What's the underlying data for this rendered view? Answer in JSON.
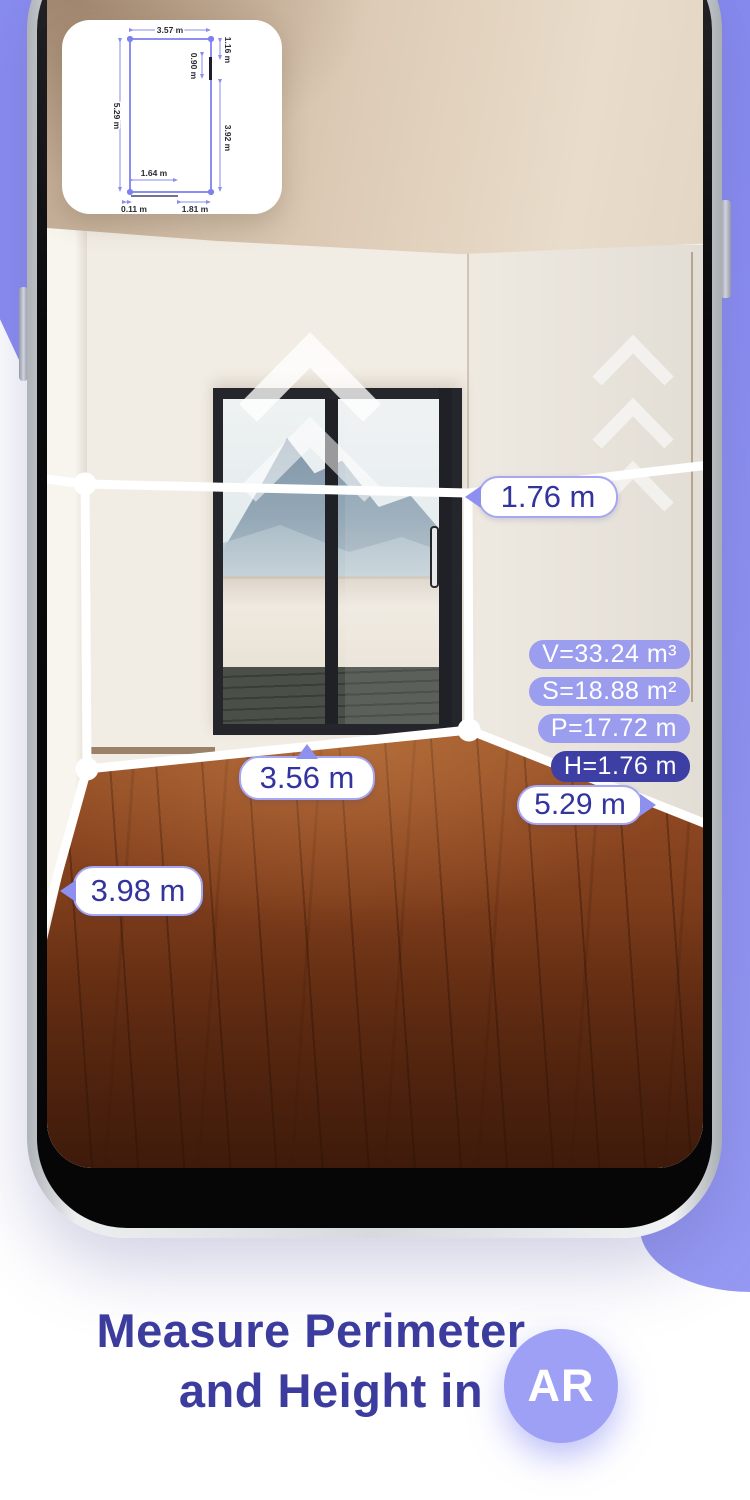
{
  "floor_plan": {
    "top": "3.57 m",
    "right_top": "1.16 m",
    "window": "0.90 m",
    "left": "5.29 m",
    "right_bottom": "3.92 m",
    "door": "1.64 m",
    "bottom_left": "0.11 m",
    "bottom_right": "1.81 m"
  },
  "ar": {
    "height_label": "1.76 m",
    "width_label": "3.56 m",
    "left_depth_label": "3.98 m",
    "right_depth_label": "5.29 m",
    "stats": {
      "volume": "V=33.24 m³",
      "surface": "S=18.88 m²",
      "perimeter": "P=17.72 m",
      "height": "H=1.76 m"
    }
  },
  "caption": {
    "line1": "Measure Perimeter",
    "line2": "and Height in",
    "badge": "AR"
  },
  "colors": {
    "accent": "#8a8df1",
    "accent_dark": "#3e3fa4",
    "text_indigo": "#33349d"
  }
}
